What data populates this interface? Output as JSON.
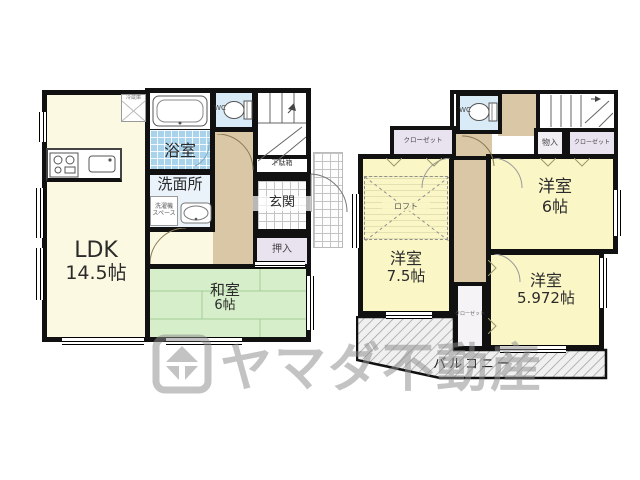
{
  "watermark": {
    "brand": "ヤマダ不動産",
    "logo": "yamada-diamond-logo"
  },
  "floor1": {
    "ldk": {
      "name": "LDK",
      "size": "14.5帖"
    },
    "washitsu": {
      "name": "和室",
      "size": "6帖"
    },
    "bath": "浴室",
    "washroom": "洗面所",
    "wc": "WC",
    "laundry": {
      "line1": "洗濯機",
      "line2": "スペース"
    },
    "fridge": "冷蔵庫",
    "getabako": "下駄箱",
    "genkan": "玄関",
    "oshiire": "押入"
  },
  "floor2": {
    "wc": "WC",
    "closet_top_left": "クローゼット",
    "closet_right": "クローゼット",
    "monoire": "物入",
    "room6": {
      "name": "洋室",
      "size": "6帖"
    },
    "room75": {
      "name": "洋室",
      "size": "7.5帖"
    },
    "room5972": {
      "name": "洋室",
      "size": "5.972帖"
    },
    "loft": "ロフト",
    "closet_small": "クローゼット",
    "balcony": "バルコニー"
  },
  "colors": {
    "wall": "#111111",
    "ldk_fill": "#FCF9E2",
    "tatami_fill": "#D6EEC9",
    "western_fill": "#FAF6C6",
    "bath_fill": "#A9D3EA",
    "wc_fill": "#D8EBF7",
    "washroom_fill": "#EAF3FA",
    "hall_fill": "#D9C7A5",
    "closet_fill": "#E9E3EF",
    "watermark_gray": "#8D8D8D"
  }
}
